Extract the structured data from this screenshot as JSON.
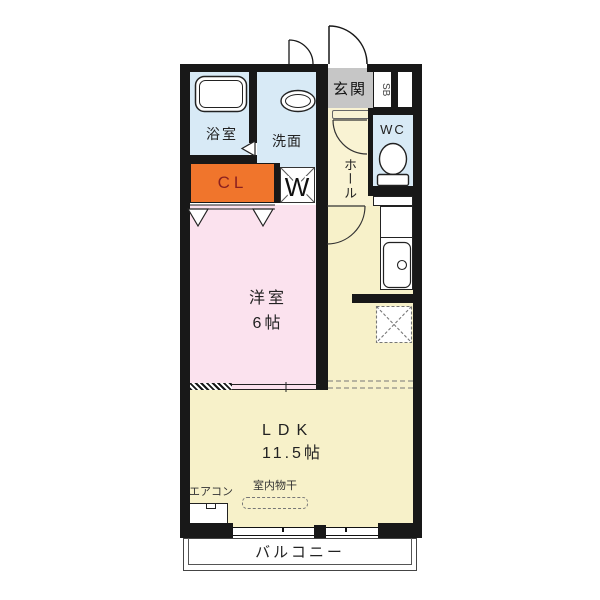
{
  "rooms": {
    "bathroom": {
      "label": "浴室"
    },
    "washroom": {
      "label": "洗面"
    },
    "entrance": {
      "label": "玄関"
    },
    "shoe_box": {
      "label": "SB"
    },
    "wc": {
      "label": "WC"
    },
    "hall": {
      "label": "ホール"
    },
    "closet": {
      "label": "CL"
    },
    "washer": {
      "label": "W"
    },
    "western_room": {
      "label": "洋室",
      "size": "6帖"
    },
    "ldk": {
      "label": "LDK",
      "size": "11.5帖"
    },
    "balcony": {
      "label": "バルコニー"
    }
  },
  "annotations": {
    "aircon": "エアコン",
    "indoor_drying": "室内物干"
  },
  "colors": {
    "wall": "#181818",
    "water_rooms": "#d8eaf6",
    "ldk": "#f7f1c9",
    "hall": "#f9f3d3",
    "bedroom": "#fbe2ee",
    "closet": "#f0752c",
    "closet_text": "#8b2020",
    "entrance": "#c6c6c6"
  }
}
